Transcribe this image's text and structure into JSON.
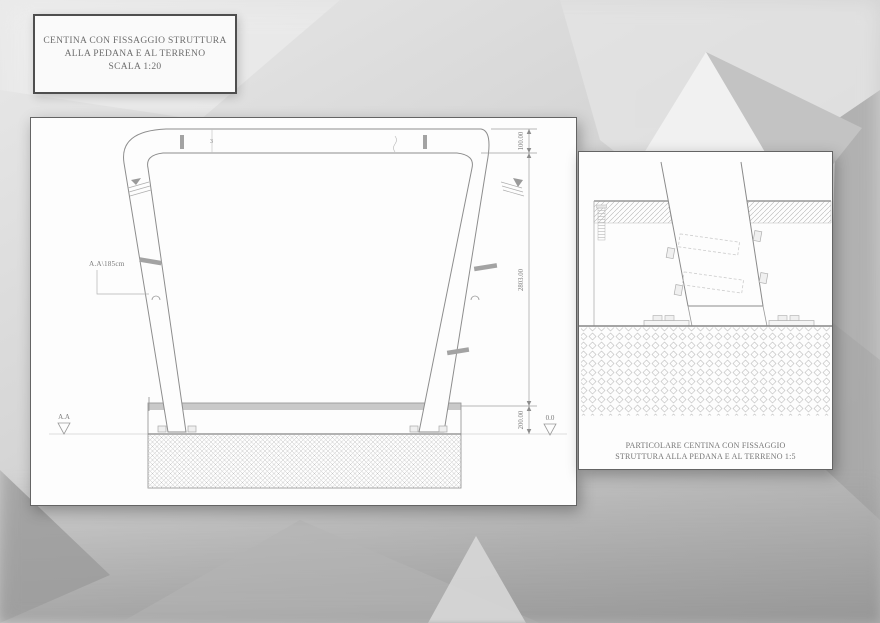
{
  "title_box": {
    "lines": [
      "CENTINA CON FISSAGGIO STRUTTURA",
      "ALLA PEDANA E AL TERRENO",
      "SCALA 1:20"
    ]
  },
  "main_panel": {
    "label_section": "A.A\\185cm",
    "level_left": "A.A",
    "level_right": "0.0",
    "joint_mark": "3",
    "dims": {
      "tube_width": "100.00",
      "height": "2803.00",
      "base": "200.00"
    }
  },
  "detail_panel": {
    "caption": [
      "PARTICOLARE CENTINA CON FISSAGGIO",
      "STRUTTURA ALLA PEDANA E AL TERRENO 1:5"
    ]
  },
  "colors": {
    "background_light": "#e9e9e9",
    "background_dark": "#9d9d9d",
    "panel": "#fdfdfd",
    "panel_border": "#646464",
    "line": "#8a8a8a",
    "line_light": "#b5b5b5",
    "text": "#6d6d6d",
    "hatch": "#c4c4c4",
    "deck_band": "#c9c9c9"
  }
}
